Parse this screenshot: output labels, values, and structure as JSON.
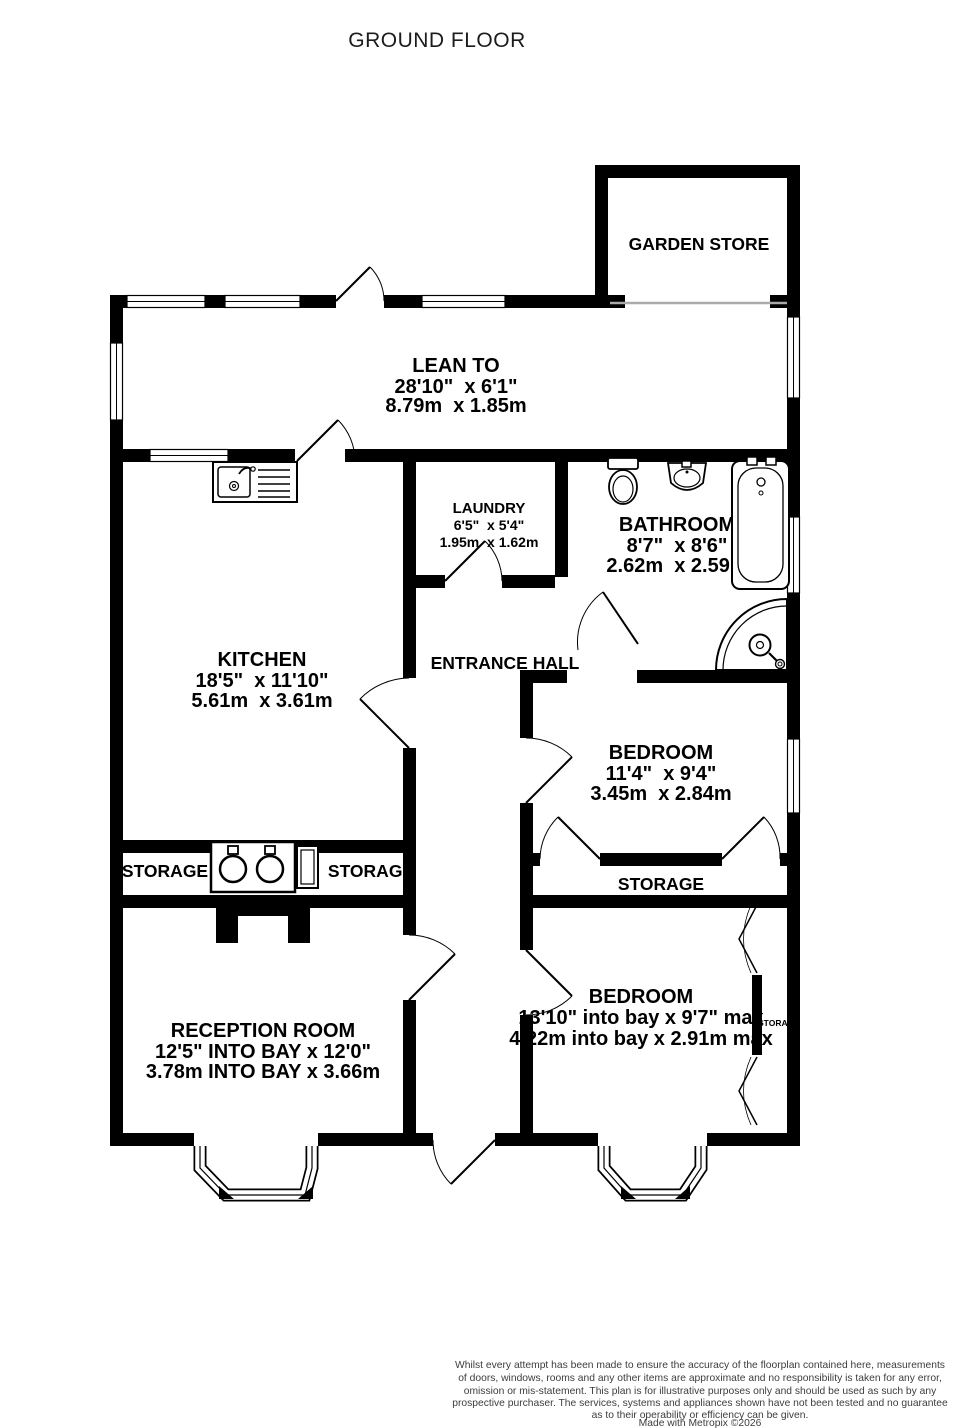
{
  "title": "GROUND FLOOR",
  "rooms": {
    "garden_store": {
      "name": "GARDEN STORE"
    },
    "lean_to": {
      "name": "LEAN TO",
      "dim_imperial": "28'10\"  x 6'1\"",
      "dim_metric": "8.79m  x 1.85m"
    },
    "laundry": {
      "name": "LAUNDRY",
      "dim_imperial": "6'5\"  x 5'4\"",
      "dim_metric": "1.95m  x 1.62m"
    },
    "bathroom": {
      "name": "BATHROOM",
      "dim_imperial": "8'7\"  x 8'6\"",
      "dim_metric": "2.62m  x 2.59m"
    },
    "kitchen": {
      "name": "KITCHEN",
      "dim_imperial": "18'5\"  x 11'10\"",
      "dim_metric": "5.61m  x 3.61m"
    },
    "entrance_hall": {
      "name": "ENTRANCE HALL"
    },
    "bedroom_1": {
      "name": "BEDROOM",
      "dim_imperial": "11'4\"  x 9'4\"",
      "dim_metric": "3.45m  x 2.84m"
    },
    "bedroom_2": {
      "name": "BEDROOM",
      "dim_imperial": "13'10\" into bay x 9'7\" max",
      "dim_metric": "4.22m into bay x 2.91m max"
    },
    "reception": {
      "name": "RECEPTION ROOM",
      "dim_imperial": "12'5\" INTO BAY x 12'0\"",
      "dim_metric": "3.78m INTO BAY x 3.66m"
    },
    "storage_kitchen_left": {
      "name": "STORAGE"
    },
    "storage_kitchen_right": {
      "name": "STORAGE"
    },
    "storage_landing": {
      "name": "STORAGE"
    },
    "storage_bedroom_closet": {
      "name": "STORAGE"
    }
  },
  "footer": {
    "disclaimer_lines": [
      "Whilst every attempt has been made to ensure the accuracy of the floorplan contained here, measurements",
      "of doors, windows, rooms and any other items are approximate and no responsibility is taken for any error,",
      "omission or mis-statement. This plan is for illustrative purposes only and should be used as such by any",
      "prospective purchaser. The services, systems and appliances shown have not been tested and no guarantee",
      "as to their operability or efficiency can be given."
    ],
    "credit": "Made with Metropix ©2026"
  },
  "colors": {
    "wall": "#000000",
    "background": "#ffffff",
    "text": "#000000",
    "footer_text": "#3d3d3d",
    "opening_line": "#aaaaaa"
  }
}
